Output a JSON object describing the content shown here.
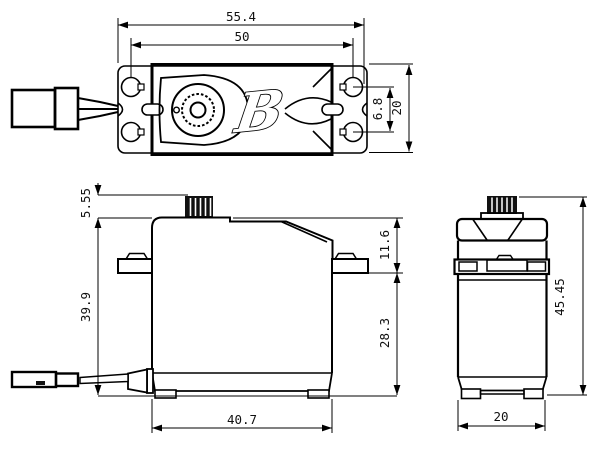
{
  "drawing": {
    "type": "servo-dimensional-drawing",
    "line_color": "#000000",
    "background": "#ffffff",
    "logo_glyph": "B",
    "dims": {
      "top_length_overall": "55.4",
      "top_hole_spacing": "50",
      "top_hole_offset": "6.8",
      "top_width": "20",
      "side_shaft_height": "5.55",
      "side_body_height": "39.9",
      "side_top_to_flange": "11.6",
      "side_flange_to_bottom": "28.3",
      "side_body_length": "40.7",
      "end_total_height": "45.45",
      "end_width": "20"
    }
  }
}
